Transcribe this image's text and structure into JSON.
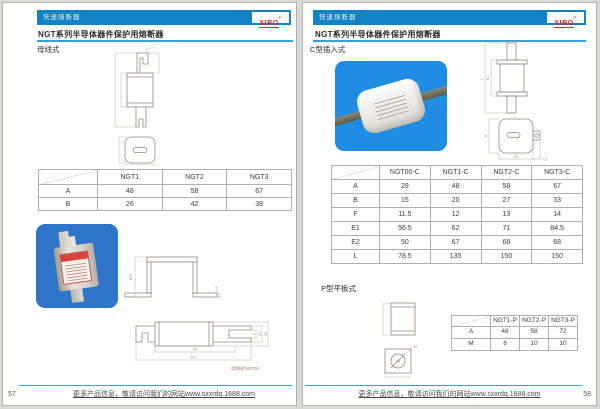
{
  "header": {
    "label": "快速熔断器",
    "brand": "XIRO",
    "brand_reg": "®"
  },
  "title": "NGT系列半导体器件保护用熔断器",
  "footer": {
    "text": "更多产品信息，敬请访问我们的网站www.sxxrdq.1688.com"
  },
  "colors": {
    "header_bar": "#1282c4",
    "accent_line": "#35a1d7",
    "brand_red": "#e02828",
    "photo_blue_left": "#2e74c9",
    "photo_blue_right": "#1f8ee2",
    "drawing_stroke": "#97877a",
    "table_border": "#b0b0ae"
  },
  "left_page": {
    "page_number": "57",
    "section": "母线式",
    "caption": "母线式NGT00",
    "table": {
      "columns": [
        "NGT1",
        "NGT2",
        "NGT3"
      ],
      "rows": [
        {
          "label": "A",
          "values": [
            "48",
            "58",
            "67"
          ]
        },
        {
          "label": "B",
          "values": [
            "26",
            "42",
            "38"
          ]
        }
      ]
    },
    "dims": {
      "bracket_height": "68.5",
      "foot": "2.5",
      "body_width": "80",
      "total_width": "100",
      "slot": "9",
      "blade": "20",
      "height": "28"
    }
  },
  "right_page": {
    "page_number": "58",
    "section_c": "C型插入式",
    "section_p": "P型平板式",
    "table_c": {
      "columns": [
        "NGT00-C",
        "NGT1-C",
        "NGT2-C",
        "NGT3-C"
      ],
      "rows": [
        {
          "label": "A",
          "values": [
            "29",
            "48",
            "58",
            "67"
          ]
        },
        {
          "label": "B",
          "values": [
            "15",
            "20",
            "27",
            "33"
          ]
        },
        {
          "label": "F",
          "values": [
            "11.5",
            "12",
            "13",
            "14"
          ]
        },
        {
          "label": "E1",
          "values": [
            "56.5",
            "62",
            "71",
            "84.5"
          ]
        },
        {
          "label": "E2",
          "values": [
            "50",
            "67",
            "68",
            "68"
          ]
        },
        {
          "label": "L",
          "values": [
            "78.5",
            "135",
            "150",
            "150"
          ]
        }
      ]
    },
    "table_p": {
      "columns": [
        "NGT1-P",
        "NGT2-P",
        "NGT3-P"
      ],
      "rows": [
        {
          "label": "A",
          "values": [
            "48",
            "58",
            "72"
          ]
        },
        {
          "label": "M",
          "values": [
            "8",
            "10",
            "10"
          ]
        }
      ]
    },
    "dims": {
      "length": "L",
      "e1": "E1",
      "f": "F",
      "a": "A",
      "width": "23",
      "tab": "7.5",
      "m": "M"
    }
  }
}
